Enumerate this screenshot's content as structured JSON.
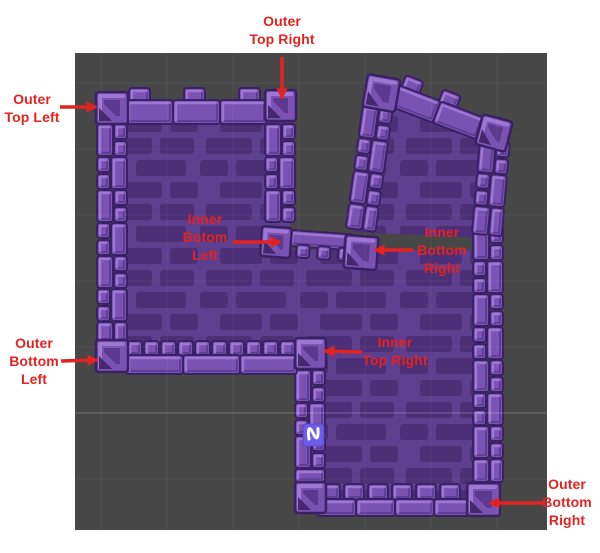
{
  "scene": {
    "description": "Tilemap corner-piece reference screenshot (scene view with annotated castle walls)",
    "page_background": "#ffffff",
    "canvas_color": "#474747",
    "grid": {
      "spacing_px": 66,
      "line_color": "#ffffff",
      "line_opacity": 0.05,
      "axis_line_y": 413,
      "axis_line_opacity": 0.16
    }
  },
  "palette": {
    "tile_face": "#7a52b2",
    "tile_light": "#9d77d2",
    "tile_shade": "#5e3b95",
    "tile_outline": "#3a2064",
    "tile_dark": "#5c398e",
    "tile_deep": "#452770",
    "interior_base": "#5e3e8e",
    "interior_brick": "#4c2f76",
    "sprite_fill": "#6c5ce7",
    "sprite_glyph_color": "#ffffff",
    "label_red": "#e32320"
  },
  "sprite": {
    "name": "squiggle-sprite",
    "glyph": "N-squiggle"
  },
  "annotations": [
    {
      "id": "outer-top-left",
      "lines": [
        "Outer",
        "Top Left"
      ]
    },
    {
      "id": "outer-top-right",
      "lines": [
        "Outer",
        "Top Right"
      ]
    },
    {
      "id": "inner-botom-left",
      "lines": [
        "Inner",
        "Botom",
        "Left"
      ]
    },
    {
      "id": "inner-bottom-right",
      "lines": [
        "Inner",
        "Bottom",
        "Right"
      ]
    },
    {
      "id": "outer-bottom-left",
      "lines": [
        "Outer",
        "Bottom",
        "Left"
      ]
    },
    {
      "id": "inner-top-right",
      "lines": [
        "Inner",
        "Top Right"
      ]
    },
    {
      "id": "outer-bottom-right",
      "lines": [
        "Outer",
        "Bottom",
        "Right"
      ]
    }
  ]
}
